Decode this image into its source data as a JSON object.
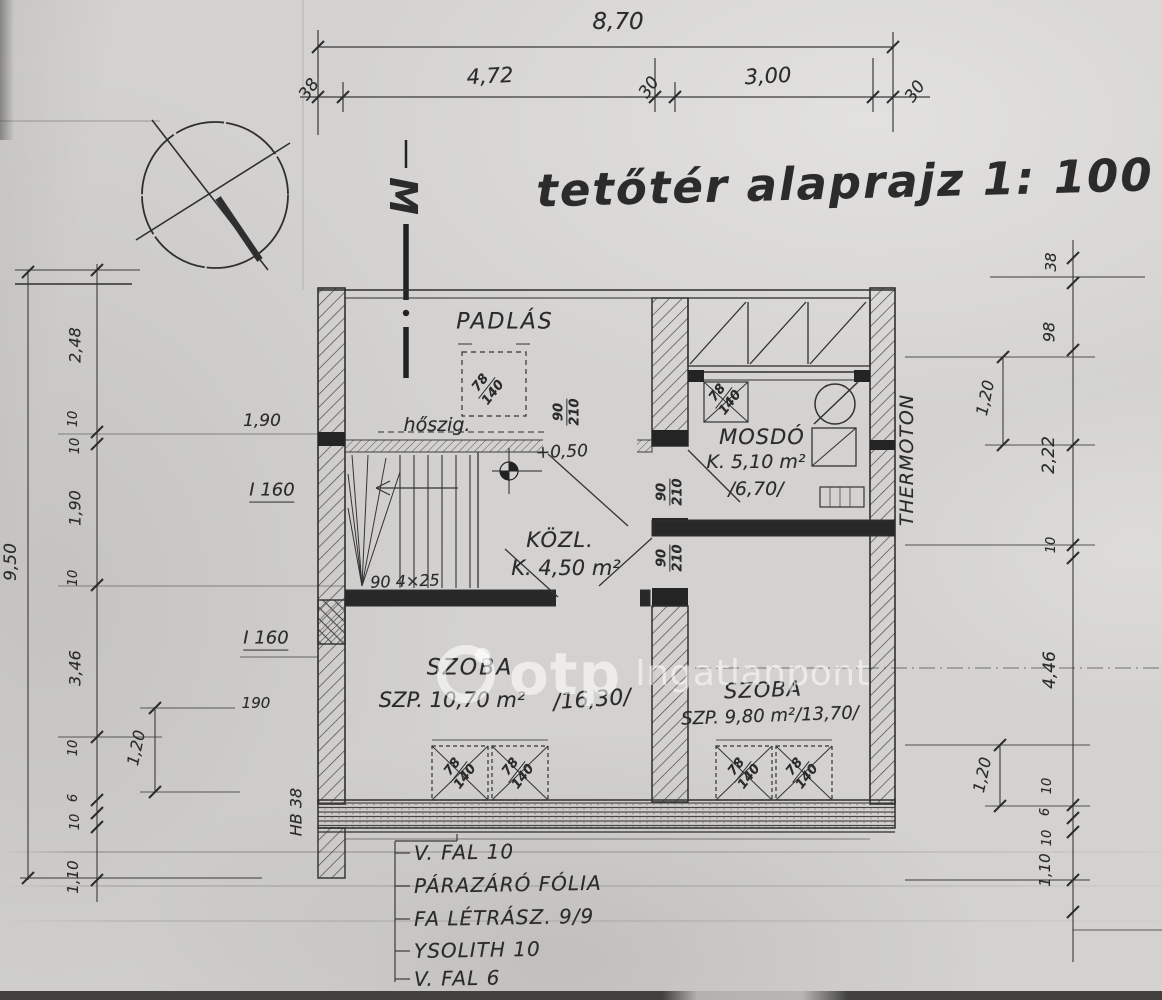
{
  "title": "tetőtér alaprajz 1: 100",
  "section_marker": "M",
  "watermark": {
    "brand": "otp",
    "suffix": "Ingatlanpont"
  },
  "rooms": {
    "padlas": {
      "name": "PADLÁS"
    },
    "mosdo": {
      "name": "MOSDÓ",
      "area": "K. 5,10 m²",
      "area_alt": "/6,70/"
    },
    "kozl": {
      "name": "KÖZL.",
      "area": "K. 4,50 m²"
    },
    "szoba_left": {
      "name": "SZOBA",
      "area": "SZP. 10,70 m²",
      "area_alt": "/16,30/"
    },
    "szoba_right": {
      "name": "SZOBA",
      "area": "SZP. 9,80 m²/13,70/"
    }
  },
  "dims": {
    "top_total": "8,70",
    "top_segments": [
      "38",
      "4,72",
      "30",
      "3,00",
      "30"
    ],
    "left_total": "9,50",
    "left_chain": [
      "2,48",
      "10",
      "10",
      "1,90",
      "10",
      "3,46",
      "10",
      "6",
      "10",
      "1,10"
    ],
    "left_inner": {
      "window": "1,20",
      "floor": "190"
    },
    "right_chain": [
      "38",
      "98",
      "2,22",
      "10",
      "4,46",
      "10",
      "6",
      "10",
      "1,10"
    ],
    "right_inner": {
      "upper": "1,20",
      "lower": "1,20"
    }
  },
  "doors": {
    "kozl_top": {
      "w": "90",
      "h": "210"
    },
    "mosdo": {
      "w": "90",
      "h": "210"
    },
    "szoba_right": {
      "w": "90",
      "h": "210"
    }
  },
  "windows": {
    "padlas": {
      "w": "78",
      "h": "140"
    },
    "mosdo": {
      "w": "78",
      "h": "140"
    },
    "szoba_left_a": {
      "w": "78",
      "h": "140"
    },
    "szoba_left_b": {
      "w": "78",
      "h": "140"
    },
    "szoba_right_a": {
      "w": "78",
      "h": "140"
    },
    "szoba_right_b": {
      "w": "78",
      "h": "140"
    }
  },
  "annotations": {
    "hoszig": "hőszig.",
    "level": "+0,50",
    "stair_note": "90  4×25",
    "thermoton": "THERMOTON",
    "hb": "HB 38",
    "beam_upper": "I 160",
    "beam_lower": "I 160",
    "dim_190": "1,90"
  },
  "legend": [
    "V. FAL 10",
    "PÁRAZÁRÓ FÓLIA",
    "FA LÉTRÁSZ. 9/9",
    "YSOLITH 10",
    "V. FAL 6"
  ]
}
